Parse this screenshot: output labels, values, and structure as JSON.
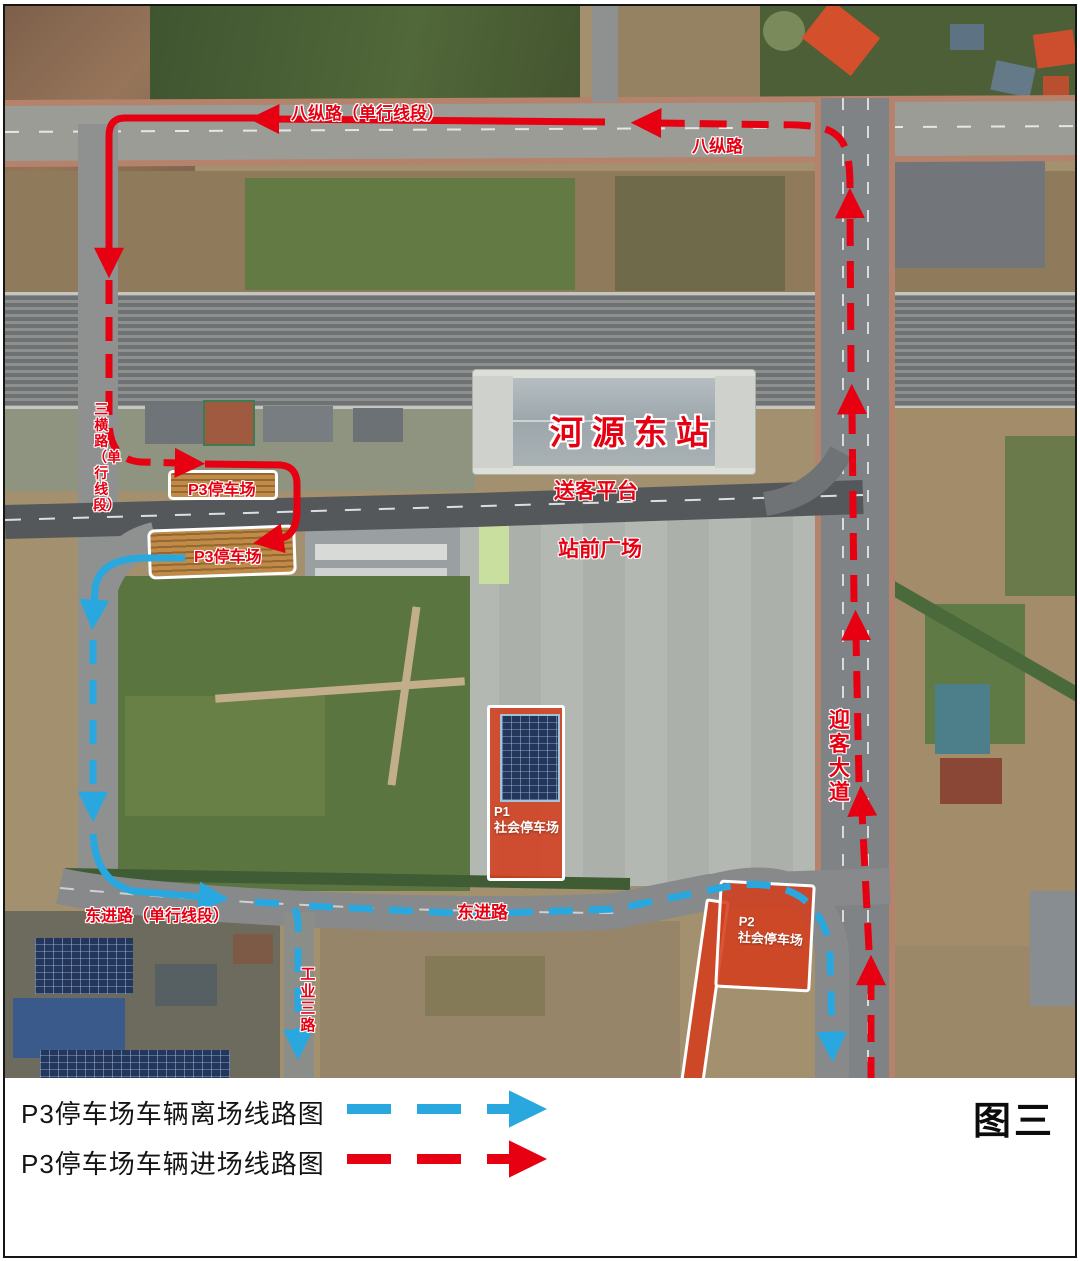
{
  "map": {
    "labels": {
      "bazong_oneway": "八纵路（单行线段）",
      "bazong": "八纵路",
      "sanheng_oneway": "三横路（单行线段）",
      "p3_box": "P3停车场",
      "p3_lot": "P3停车场",
      "station": "河源东站",
      "songke": "送客平台",
      "zhanqian": "站前广场",
      "yingke": "迎客大道",
      "dongjin_oneway": "东进路（单行线段）",
      "dongjin": "东进路",
      "gongye": "工业三路",
      "p1_line1": "P1",
      "p1_line2": "社会停车场",
      "p2_line1": "P2",
      "p2_line2": "社会停车场"
    },
    "routes": {
      "entry_color": "#e60012",
      "exit_color": "#29a8e0"
    }
  },
  "legend": {
    "exit_label": "P3停车场车辆离场线路图",
    "entry_label": "P3停车场车辆进场线路图",
    "figure_label": "图三",
    "exit_color": "#29a8e0",
    "entry_color": "#e60012"
  }
}
